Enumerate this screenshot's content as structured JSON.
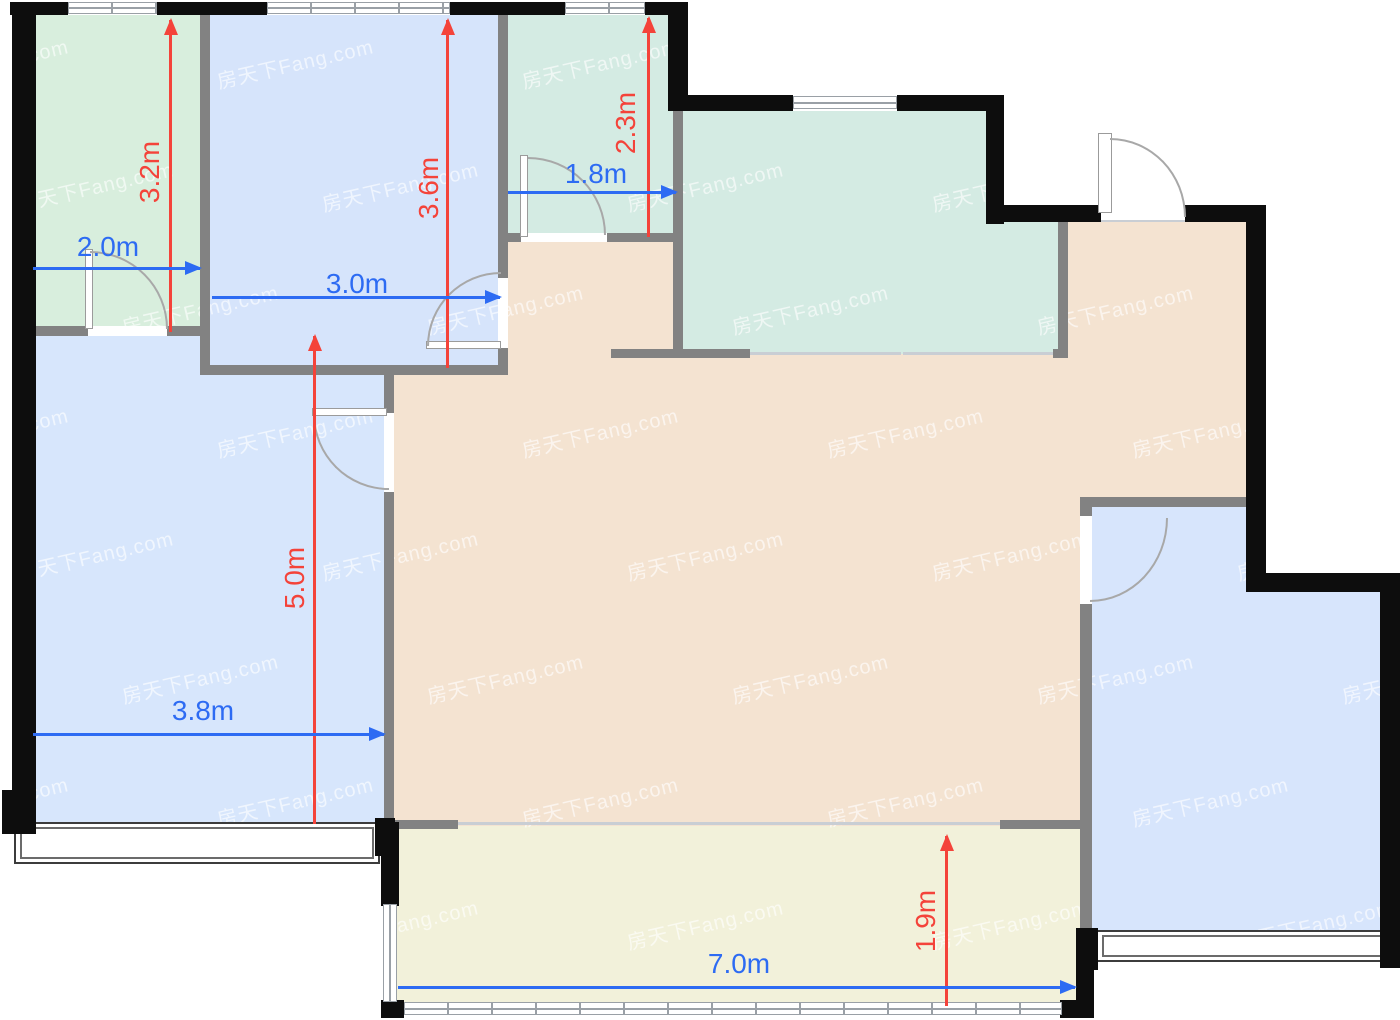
{
  "plan": {
    "type": "apartment-floor-plan",
    "watermark_text": "房天下Fang.com"
  },
  "dims": {
    "v32": {
      "label": "3.2m"
    },
    "v36": {
      "label": "3.6m"
    },
    "v23": {
      "label": "2.3m"
    },
    "v50": {
      "label": "5.0m"
    },
    "v19": {
      "label": "1.9m"
    },
    "h20": {
      "label": "2.0m"
    },
    "h30": {
      "label": "3.0m"
    },
    "h18": {
      "label": "1.8m"
    },
    "h38": {
      "label": "3.8m"
    },
    "h70": {
      "label": "7.0m"
    }
  },
  "colors": {
    "dim_red": "#f4433a",
    "dim_blue": "#2d6bf3",
    "wall_black": "#0d0d0d",
    "wall_gray": "#828282",
    "room_green_pale": "#d8eedd",
    "room_teal": "#d4ebe3",
    "room_blue": "#d6e4fb",
    "room_beige": "#f4e3d1",
    "room_yellow": "#f2f1da",
    "watermark": "rgba(255,255,255,0.62)"
  }
}
